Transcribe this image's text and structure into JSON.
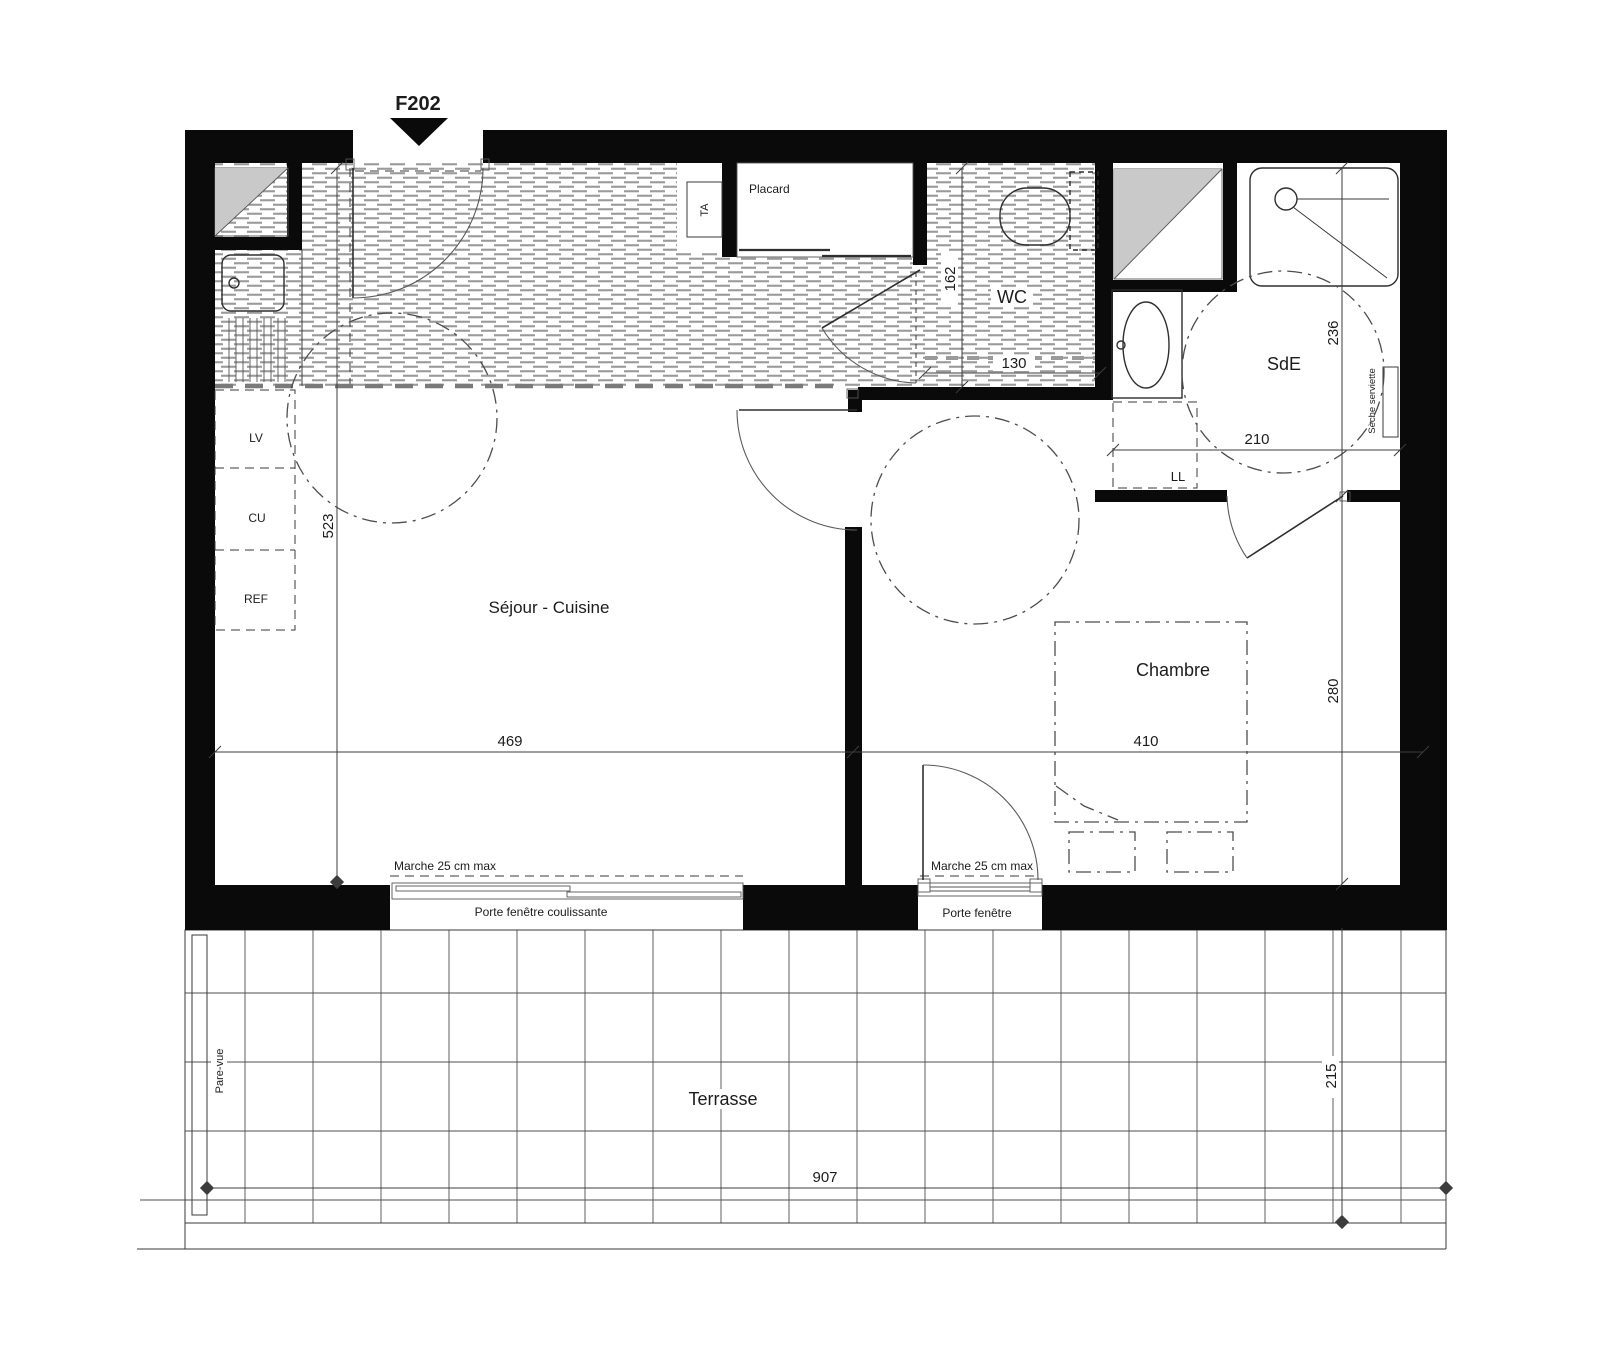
{
  "plan": {
    "unit": "F202",
    "rooms": {
      "sejour_cuisine": "Séjour - Cuisine",
      "chambre": "Chambre",
      "wc": "WC",
      "sde": "SdE",
      "terrasse": "Terrasse",
      "placard": "Placard"
    },
    "equipment": {
      "ta": "TA",
      "lv": "LV",
      "cu": "CU",
      "ref": "REF",
      "ll": "LL",
      "seche_serviette": "Sèche serviette",
      "pare_vue": "Pare-vue"
    },
    "annotations": {
      "marche_sejour": "Marche 25 cm max",
      "marche_chambre": "Marche 25 cm max",
      "porte_fenetre_coulissante": "Porte fenêtre coulissante",
      "porte_fenetre": "Porte fenêtre"
    },
    "dimensions_cm": {
      "sejour_depth": "523",
      "sejour_width": "469",
      "wc_depth": "162",
      "wc_width": "130",
      "sde_depth": "236",
      "sde_width": "210",
      "chambre_depth": "280",
      "chambre_width": "410",
      "terrasse_depth": "215",
      "terrasse_width": "907"
    },
    "colors": {
      "wall": "#0a0a0a",
      "floor_hatch": "#9a9a9a",
      "duct_fill": "#c9c9c9"
    }
  }
}
